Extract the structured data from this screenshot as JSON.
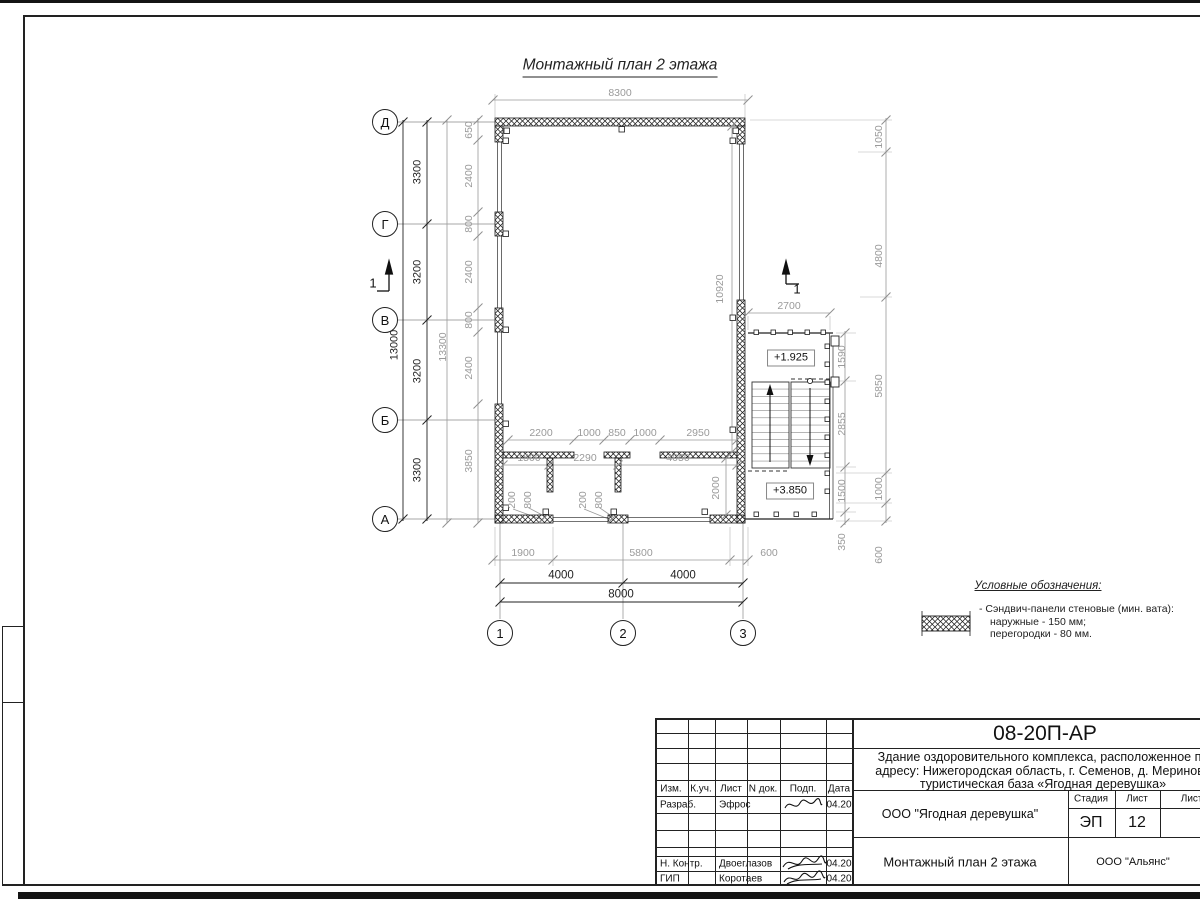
{
  "colors": {
    "paper": "#ffffff",
    "line": "#1b1b1b",
    "dim_gray": "#9a9a9a",
    "dim_dark": "#222222"
  },
  "plan": {
    "title": "Монтажный план 2 этажа",
    "labels": [
      {
        "t": "8300",
        "x": 620,
        "y": 93,
        "c": "g"
      },
      {
        "t": "2700",
        "x": 789,
        "y": 306,
        "c": "g"
      },
      {
        "t": "2200",
        "x": 541,
        "y": 433,
        "c": "g"
      },
      {
        "t": "1000",
        "x": 589,
        "y": 433,
        "c": "g"
      },
      {
        "t": "850",
        "x": 617,
        "y": 433,
        "c": "g"
      },
      {
        "t": "1000",
        "x": 645,
        "y": 433,
        "c": "g"
      },
      {
        "t": "2950",
        "x": 698,
        "y": 433,
        "c": "g"
      },
      {
        "t": "1500",
        "x": 529,
        "y": 458,
        "c": "g"
      },
      {
        "t": "2290",
        "x": 585,
        "y": 458,
        "c": "g"
      },
      {
        "t": "4050",
        "x": 678,
        "y": 458,
        "c": "g"
      },
      {
        "t": "1900",
        "x": 523,
        "y": 553,
        "c": "g"
      },
      {
        "t": "5800",
        "x": 641,
        "y": 553,
        "c": "g"
      },
      {
        "t": "600",
        "x": 769,
        "y": 553,
        "c": "g"
      },
      {
        "t": "650",
        "x": 469,
        "y": 130,
        "c": "gr"
      },
      {
        "t": "2400",
        "x": 469,
        "y": 176,
        "c": "gr"
      },
      {
        "t": "800",
        "x": 469,
        "y": 224,
        "c": "gr"
      },
      {
        "t": "2400",
        "x": 469,
        "y": 272,
        "c": "gr"
      },
      {
        "t": "800",
        "x": 469,
        "y": 320,
        "c": "gr"
      },
      {
        "t": "2400",
        "x": 469,
        "y": 368,
        "c": "gr"
      },
      {
        "t": "3850",
        "x": 469,
        "y": 461,
        "c": "gr"
      },
      {
        "t": "13300",
        "x": 443,
        "y": 347,
        "c": "gr"
      },
      {
        "t": "1050",
        "x": 879,
        "y": 137,
        "c": "gr"
      },
      {
        "t": "4800",
        "x": 879,
        "y": 256,
        "c": "gr"
      },
      {
        "t": "5850",
        "x": 879,
        "y": 386,
        "c": "gr"
      },
      {
        "t": "1000",
        "x": 879,
        "y": 489,
        "c": "gr"
      },
      {
        "t": "600",
        "x": 879,
        "y": 555,
        "c": "gr"
      },
      {
        "t": "1590",
        "x": 842,
        "y": 357,
        "c": "gr"
      },
      {
        "t": "2855",
        "x": 842,
        "y": 424,
        "c": "gr"
      },
      {
        "t": "1500",
        "x": 842,
        "y": 491,
        "c": "gr"
      },
      {
        "t": "350",
        "x": 842,
        "y": 542,
        "c": "gr"
      },
      {
        "t": "10920",
        "x": 720,
        "y": 289,
        "c": "gr"
      },
      {
        "t": "2000",
        "x": 716,
        "y": 488,
        "c": "gr"
      },
      {
        "t": "200",
        "x": 512,
        "y": 500,
        "c": "gr"
      },
      {
        "t": "800",
        "x": 528,
        "y": 500,
        "c": "gr"
      },
      {
        "t": "200",
        "x": 583,
        "y": 500,
        "c": "gr"
      },
      {
        "t": "800",
        "x": 599,
        "y": 500,
        "c": "gr"
      },
      {
        "t": "4000",
        "x": 561,
        "y": 576,
        "c": "d"
      },
      {
        "t": "4000",
        "x": 683,
        "y": 576,
        "c": "d"
      },
      {
        "t": "8000",
        "x": 621,
        "y": 595,
        "c": "d"
      },
      {
        "t": "3300",
        "x": 418,
        "y": 172,
        "c": "dr"
      },
      {
        "t": "3200",
        "x": 418,
        "y": 272,
        "c": "dr"
      },
      {
        "t": "3200",
        "x": 418,
        "y": 371,
        "c": "dr"
      },
      {
        "t": "3300",
        "x": 418,
        "y": 470,
        "c": "dr"
      },
      {
        "t": "13000",
        "x": 395,
        "y": 345,
        "c": "dr"
      },
      {
        "t": "Д",
        "x": 385,
        "y": 122,
        "c": "bub"
      },
      {
        "t": "Г",
        "x": 385,
        "y": 224,
        "c": "bub"
      },
      {
        "t": "В",
        "x": 385,
        "y": 320,
        "c": "bub"
      },
      {
        "t": "Б",
        "x": 385,
        "y": 420,
        "c": "bub"
      },
      {
        "t": "А",
        "x": 385,
        "y": 519,
        "c": "bub"
      },
      {
        "t": "1",
        "x": 500,
        "y": 633,
        "c": "bub"
      },
      {
        "t": "2",
        "x": 623,
        "y": 633,
        "c": "bub"
      },
      {
        "t": "3",
        "x": 743,
        "y": 633,
        "c": "bub"
      },
      {
        "t": "+1.925",
        "x": 791,
        "y": 358,
        "c": "lvl"
      },
      {
        "t": "+3.850",
        "x": 790,
        "y": 491,
        "c": "lvl"
      },
      {
        "t": "1",
        "x": 373,
        "y": 283,
        "c": "sec"
      },
      {
        "t": "1",
        "x": 797,
        "y": 289,
        "c": "sec"
      }
    ]
  },
  "legend": {
    "title": "Условные обозначения:",
    "item_lines": [
      "- Сэндвич-панели стеновые (мин. вата):",
      "наружные - 150 мм;",
      "перегородки - 80 мм."
    ]
  },
  "title_block": {
    "code": "08-20П-АР",
    "desc_line1": "Здание оздоровительного комплекса, расположенное по",
    "desc_line2": "адресу: Нижегородская область, г. Семенов, д. Мериново",
    "desc_line3": "туристическая база «Ягодная деревушка»",
    "col_izm": "Изм.",
    "col_kuch": "К.уч.",
    "col_list": "Лист",
    "col_ndoc": "N док.",
    "col_podp": "Подп.",
    "col_data": "Дата",
    "row1_role": "Разраб.",
    "row1_name": "Эфрос",
    "row1_date": "04.20",
    "row5_role": "Н. Контр.",
    "row5_name": "Двоеглазов",
    "row5_date": "04.20",
    "row6_role": "ГИП",
    "row6_name": "Коротаев",
    "row6_date": "04.20",
    "org": "ООО \"Ягодная деревушка\"",
    "stage_label": "Стадия",
    "sheet_label": "Лист",
    "sheets_label": "Листов",
    "stage": "ЭП",
    "sheet_num": "12",
    "drawing_name": "Монтажный план 2 этажа",
    "company": "ООО \"Альянс\""
  }
}
